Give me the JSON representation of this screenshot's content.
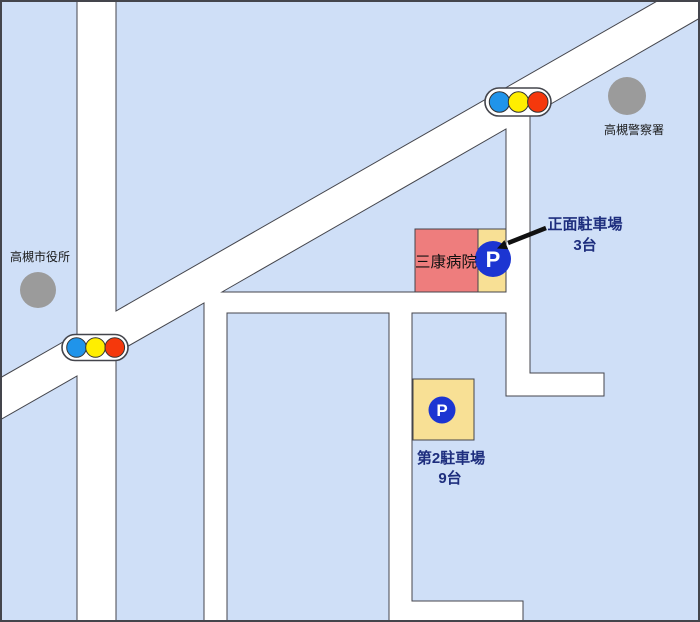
{
  "map": {
    "labels": {
      "police_station": "高槻警察署",
      "city_hall": "高槻市役所",
      "hospital": "三康病院",
      "front_parking_line1": "正面駐車場",
      "front_parking_line2": "3台",
      "second_parking_line1": "第2駐車場",
      "second_parking_line2": "9台",
      "parking_symbol": "P"
    },
    "colors": {
      "block_fill": "#cfdff7",
      "block_border": "#44454c",
      "road_white": "#ffffff",
      "hospital_fill": "#ee7d7d",
      "parking_fill": "#f8e095",
      "parking_sign_blue": "#1c35d2",
      "signal_blue": "#2094ea",
      "signal_yellow": "#ffee00",
      "signal_red": "#f5380c",
      "landmark_gray": "#9b9b9b",
      "label_navy": "#1e2e7e",
      "label_black": "#1a1a1a"
    }
  }
}
